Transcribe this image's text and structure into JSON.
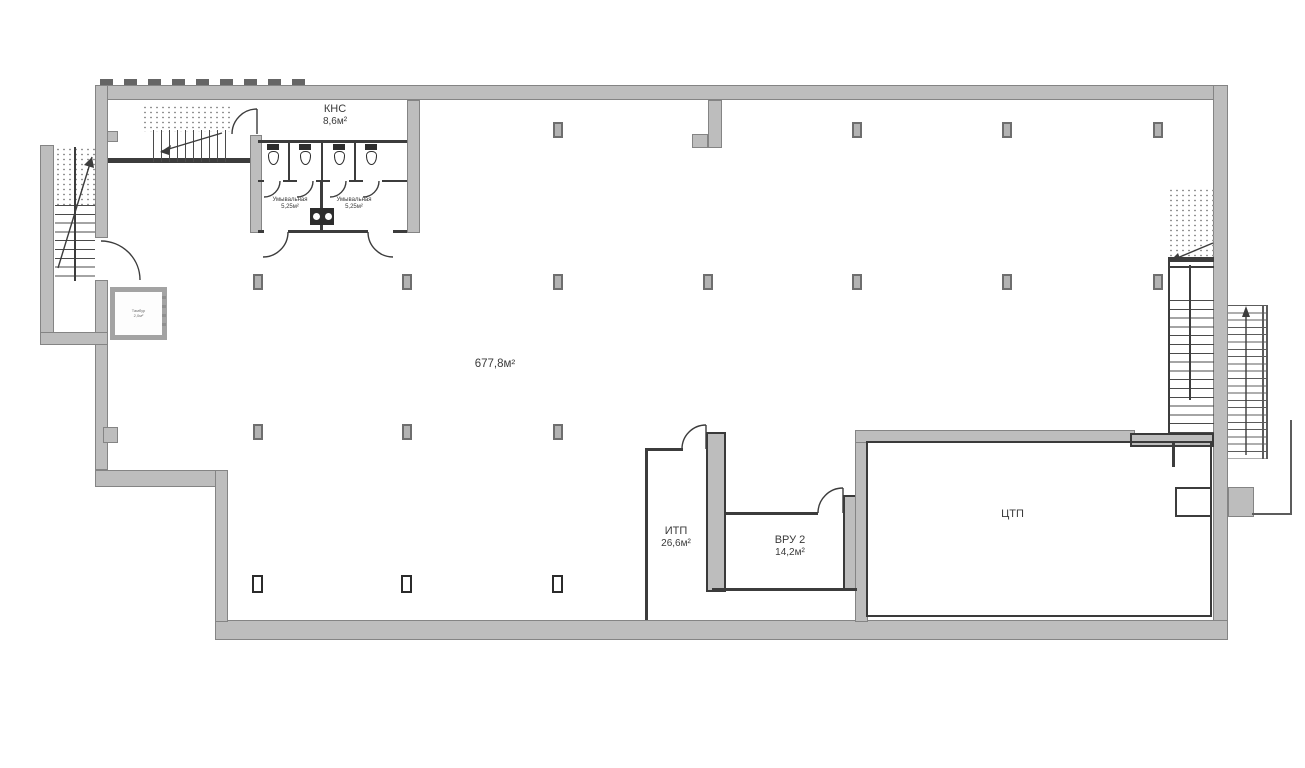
{
  "plan": {
    "rooms": {
      "kns": {
        "name": "КНС",
        "area": "8,6м²"
      },
      "washroom_left": {
        "name": "Умывальная",
        "area": "5,25м²"
      },
      "washroom_right": {
        "name": "Умывальная",
        "area": "5,25м²"
      },
      "hall": {
        "area": "677,8м²"
      },
      "itp": {
        "name": "ИТП",
        "area": "26,6м²"
      },
      "vru": {
        "name": "ВРУ 2",
        "area": "14,2м²"
      },
      "ctp": {
        "name": "ЦТП"
      },
      "vestibule": {
        "name": "Тамбур",
        "area": "2,0м²"
      }
    }
  }
}
